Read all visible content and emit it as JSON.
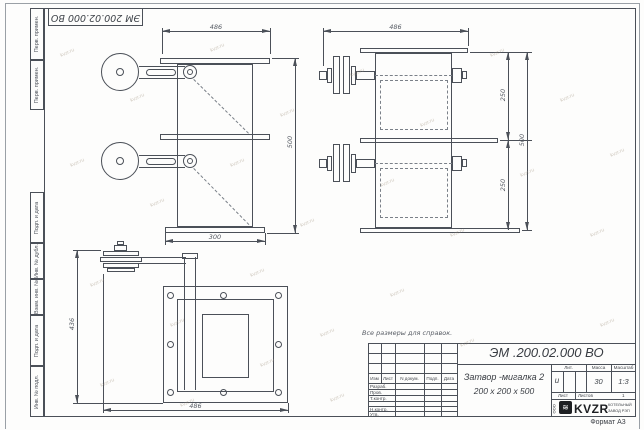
{
  "stamp": "ЭМ 200.02.000 ВО",
  "note": "Все размеры для справок.",
  "watermark": "kvzr.ru",
  "margin": {
    "b1": "Перв. примен.",
    "b2": "Перв. примен.",
    "b3": "Подп. и дата",
    "b4": "Инв. № дубл.",
    "b5": "Взам. инв. №",
    "b6": "Подп. и дата",
    "b7": "Инв. № подл."
  },
  "dims": {
    "f_w": "486",
    "f_h": "500",
    "f_b": "300",
    "s_w": "486",
    "s_h1": "250",
    "s_h2": "250",
    "s_h": "500",
    "t_h": "436",
    "t_w": "486"
  },
  "tb": {
    "designation": "ЭМ .200.02.000 ВО",
    "name1": "Затвор -мигалка 2",
    "name2": "200 х 200 х 500",
    "lit": "Лит.",
    "mass": "Масса",
    "scale": "Масштаб",
    "lit_v": "и",
    "mass_v": "30",
    "scale_v": "1:3",
    "sheet": "Лист",
    "sheets": "Листов",
    "sheets_v": "1",
    "h_izm": "Изм",
    "h_list": "Лист",
    "h_doc": "N докум.",
    "h_sign": "Подп.",
    "h_date": "Дата",
    "rows": [
      "Разраб.",
      "Пров.",
      "Т.контр.",
      "Н.контр.",
      "Утв."
    ],
    "logo_ooo": "ООО",
    "logo_brand": "KVZR",
    "logo_l1": "КОТЕЛЬНЫЙ",
    "logo_l2": "ЗАВОД РЭП",
    "format": "Формат А3"
  }
}
